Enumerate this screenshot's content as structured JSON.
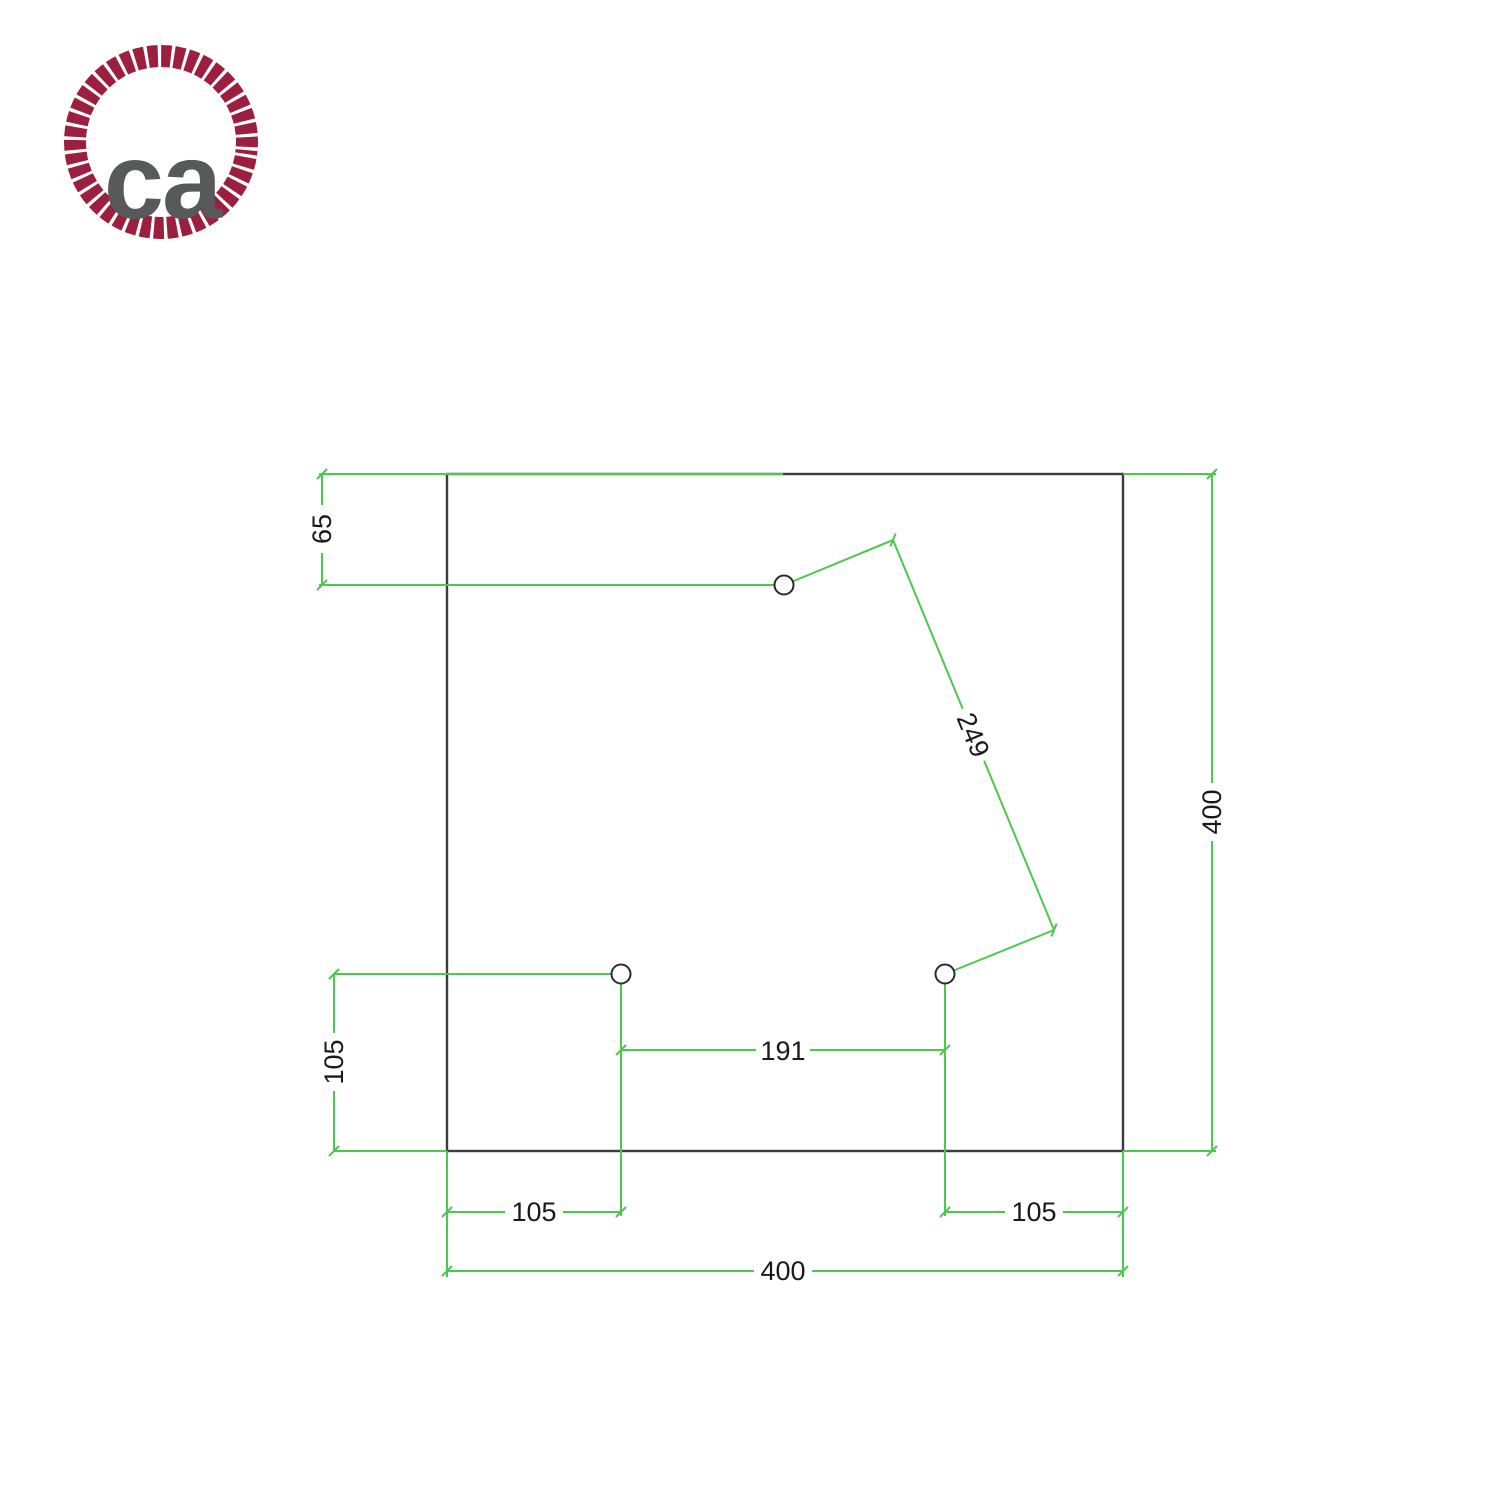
{
  "logo": {
    "text": "ca",
    "rope_color": "#9c1f40",
    "text_color": "#58595b"
  },
  "drawing": {
    "type": "technical-dimension-drawing",
    "unit": "mm",
    "outline_color": "#3c3c3c",
    "dimension_color": "#4cc94c",
    "plate": {
      "shape": "square",
      "width": 400,
      "height": 400
    },
    "holes": [
      {
        "id": "hole-top",
        "shown_offset_from_top": 65
      },
      {
        "id": "hole-bottom-left",
        "shown_offset_from_left": 105,
        "shown_offset_from_bottom": 105
      },
      {
        "id": "hole-bottom-right",
        "shown_offset_from_right": 105,
        "shown_offset_from_bottom": 105
      }
    ],
    "dimensions": [
      {
        "id": "top-hole-from-top-edge",
        "label": "65",
        "value": 65,
        "orientation": "vertical"
      },
      {
        "id": "plate-height",
        "label": "400",
        "value": 400,
        "orientation": "vertical"
      },
      {
        "id": "bottom-left-hole-from-bottom-edge",
        "label": "105",
        "value": 105,
        "orientation": "vertical"
      },
      {
        "id": "between-bottom-holes",
        "label": "191",
        "value": 191,
        "orientation": "horizontal"
      },
      {
        "id": "bottom-left-hole-from-left-edge",
        "label": "105",
        "value": 105,
        "orientation": "horizontal"
      },
      {
        "id": "bottom-right-hole-from-right-edge",
        "label": "105",
        "value": 105,
        "orientation": "horizontal"
      },
      {
        "id": "plate-width",
        "label": "400",
        "value": 400,
        "orientation": "horizontal"
      },
      {
        "id": "top-hole-to-bottom-right-hole",
        "label": "249",
        "value": 249,
        "orientation": "diagonal"
      }
    ]
  }
}
